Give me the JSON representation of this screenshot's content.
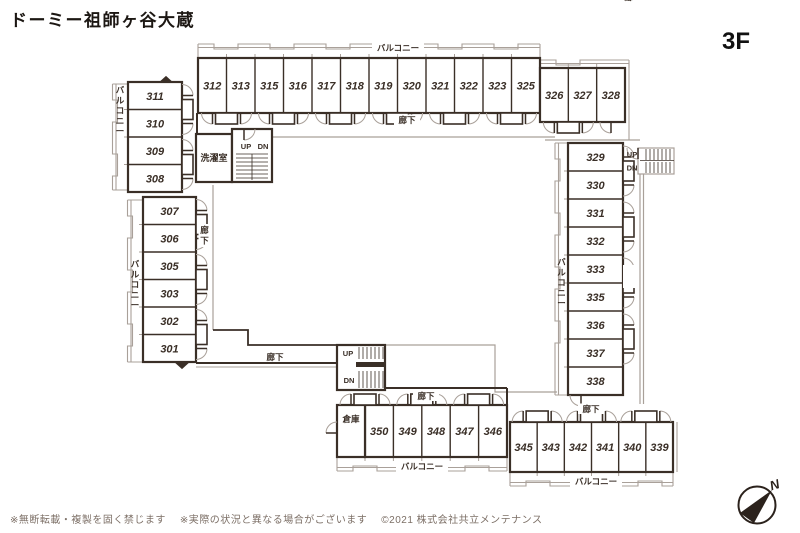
{
  "header": {
    "title": "ドーミー祖師ヶ谷大蔵",
    "floor_label": "3F"
  },
  "plan": {
    "labels": {
      "balcony": "バルコニー",
      "corridor": "廊下",
      "laundry": "洗濯室",
      "storage": "倉庫",
      "up": "UP",
      "down": "DN"
    },
    "wings": {
      "top": [
        "312",
        "313",
        "315",
        "316",
        "317",
        "318",
        "319",
        "320",
        "321",
        "322",
        "323",
        "325"
      ],
      "top_right": [
        "326",
        "327",
        "328"
      ],
      "left_upper": [
        "311",
        "310",
        "309",
        "308"
      ],
      "left_lower": [
        "307",
        "306",
        "305",
        "303",
        "302",
        "301"
      ],
      "right": [
        "329",
        "330",
        "331",
        "332",
        "333",
        "335",
        "336",
        "337",
        "338"
      ],
      "bottom_left": [
        "350",
        "349",
        "348",
        "347",
        "346"
      ],
      "bottom_right": [
        "345",
        "343",
        "342",
        "341",
        "340",
        "339"
      ]
    }
  },
  "compass": {
    "north": "N"
  },
  "footer": {
    "notes": [
      "※無断転載・複製を固く禁じます",
      "※実際の状況と異なる場合がございます",
      "©2021 株式会社共立メンテナンス"
    ]
  },
  "colors": {
    "wall": "#3a2f27",
    "light": "#a9a099",
    "text": "#3a2f27",
    "title": "#1c1713",
    "footer": "#7c6f66"
  }
}
